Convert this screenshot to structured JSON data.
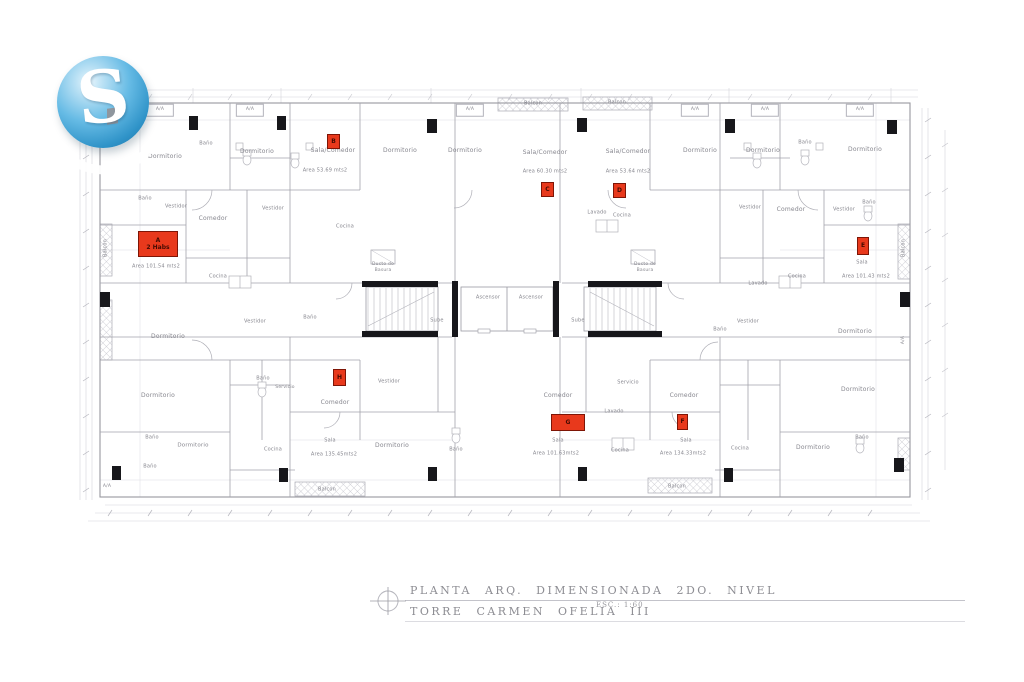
{
  "colors": {
    "unit_red": "#e8391c",
    "unit_red_border": "#7e1506",
    "line_gray": "#a3a3ab",
    "label_gray": "#86868e",
    "column_black": "#17171b",
    "logo_blue": "#4aa8d8"
  },
  "logo": {
    "letter": "S"
  },
  "title_block": {
    "line1": "PLANTA  ARQ.  DIMENSIONADA  2DO.  NIVEL",
    "line2": "TORRE  CARMEN  OFELIA  III",
    "scale": "ESC.: 1:60"
  },
  "plan": {
    "units": [
      {
        "id": "A",
        "label": "A",
        "sublabel": "2 Habs",
        "box": {
          "x": 138,
          "y": 231,
          "w": 38,
          "h": 24
        },
        "area": "Area 101.54 mts2",
        "area_pos": {
          "x": 156,
          "y": 267
        }
      },
      {
        "id": "B",
        "label": "B",
        "box": {
          "x": 327,
          "y": 134,
          "w": 11,
          "h": 13
        },
        "area": "Area 53.69 mts2",
        "area_pos": {
          "x": 325,
          "y": 171
        }
      },
      {
        "id": "C",
        "label": "C",
        "box": {
          "x": 541,
          "y": 182,
          "w": 11,
          "h": 13
        },
        "area": "Area 60.30 mts2",
        "area_pos": {
          "x": 545,
          "y": 172
        }
      },
      {
        "id": "D",
        "label": "D",
        "box": {
          "x": 613,
          "y": 183,
          "w": 11,
          "h": 13
        },
        "area": "Area 53.64 mts2",
        "area_pos": {
          "x": 628,
          "y": 172
        }
      },
      {
        "id": "E",
        "label": "E",
        "box": {
          "x": 857,
          "y": 237,
          "w": 10,
          "h": 16
        },
        "area": "Area 101.43 mts2",
        "area_pos": {
          "x": 866,
          "y": 277
        }
      },
      {
        "id": "F",
        "label": "F",
        "box": {
          "x": 677,
          "y": 414,
          "w": 9,
          "h": 14
        },
        "area": "Area 134.33mts2",
        "area_pos": {
          "x": 683,
          "y": 454
        }
      },
      {
        "id": "G",
        "label": "G",
        "box": {
          "x": 551,
          "y": 414,
          "w": 32,
          "h": 15
        },
        "area": "Area 101.63mts2",
        "area_pos": {
          "x": 556,
          "y": 454
        }
      },
      {
        "id": "H",
        "label": "H",
        "box": {
          "x": 333,
          "y": 369,
          "w": 11,
          "h": 15
        },
        "area": "Area 135.45mts2",
        "area_pos": {
          "x": 334,
          "y": 455
        }
      }
    ],
    "room_labels": [
      {
        "t": "Dormitorio",
        "x": 165,
        "y": 157
      },
      {
        "t": "Baño",
        "x": 206,
        "y": 144,
        "s": 5
      },
      {
        "t": "Dormitorio",
        "x": 257,
        "y": 152
      },
      {
        "t": "Sala/Comedor",
        "x": 333,
        "y": 151
      },
      {
        "t": "Dormitorio",
        "x": 400,
        "y": 151
      },
      {
        "t": "Dormitorio",
        "x": 465,
        "y": 151
      },
      {
        "t": "Sala/Comedor",
        "x": 545,
        "y": 153
      },
      {
        "t": "Sala/Comedor",
        "x": 628,
        "y": 152
      },
      {
        "t": "Dormitorio",
        "x": 700,
        "y": 151
      },
      {
        "t": "Dormitorio",
        "x": 763,
        "y": 151
      },
      {
        "t": "Baño",
        "x": 805,
        "y": 143,
        "s": 5
      },
      {
        "t": "Dormitorio",
        "x": 865,
        "y": 150
      },
      {
        "t": "Balcon",
        "x": 533,
        "y": 104,
        "s": 5
      },
      {
        "t": "Balcon",
        "x": 617,
        "y": 103,
        "s": 5
      },
      {
        "t": "A/A",
        "x": 160,
        "y": 110,
        "s": 4.5,
        "box": true
      },
      {
        "t": "A/A",
        "x": 250,
        "y": 110,
        "s": 4.5,
        "box": true
      },
      {
        "t": "A/A",
        "x": 470,
        "y": 110,
        "s": 4.5,
        "box": true
      },
      {
        "t": "A/A",
        "x": 695,
        "y": 110,
        "s": 4.5,
        "box": true
      },
      {
        "t": "A/A",
        "x": 765,
        "y": 110,
        "s": 4.5,
        "box": true
      },
      {
        "t": "A/A",
        "x": 860,
        "y": 110,
        "s": 4.5,
        "box": true
      },
      {
        "t": "Baño",
        "x": 145,
        "y": 199,
        "s": 5
      },
      {
        "t": "Vestidor",
        "x": 176,
        "y": 207,
        "s": 5
      },
      {
        "t": "Comedor",
        "x": 213,
        "y": 219
      },
      {
        "t": "Vestidor",
        "x": 273,
        "y": 209,
        "s": 5
      },
      {
        "t": "Cocina",
        "x": 218,
        "y": 277,
        "s": 5
      },
      {
        "t": "Cocina",
        "x": 345,
        "y": 227,
        "s": 5
      },
      {
        "t": "Lavado",
        "x": 597,
        "y": 213,
        "s": 5
      },
      {
        "t": "Cocina",
        "x": 622,
        "y": 216,
        "s": 5
      },
      {
        "t": "Vestidor",
        "x": 750,
        "y": 208,
        "s": 5
      },
      {
        "t": "Comedor",
        "x": 791,
        "y": 210
      },
      {
        "t": "Vestidor",
        "x": 844,
        "y": 210,
        "s": 5
      },
      {
        "t": "Baño",
        "x": 869,
        "y": 203,
        "s": 5
      },
      {
        "t": "Lavado",
        "x": 758,
        "y": 284,
        "s": 5
      },
      {
        "t": "Cocina",
        "x": 797,
        "y": 277,
        "s": 5
      },
      {
        "t": "Balcon",
        "x": 106,
        "y": 248,
        "s": 5,
        "r": -90
      },
      {
        "t": "Balcon",
        "x": 904,
        "y": 248,
        "s": 5,
        "r": -90
      },
      {
        "t": "Sala",
        "x": 862,
        "y": 263,
        "s": 5
      },
      {
        "t": "Ducto de",
        "x": 383,
        "y": 265,
        "s": 4.5
      },
      {
        "t": "Basura",
        "x": 383,
        "y": 271,
        "s": 4.5
      },
      {
        "t": "Ducto de",
        "x": 645,
        "y": 265,
        "s": 4.5
      },
      {
        "t": "Basura",
        "x": 645,
        "y": 271,
        "s": 4.5
      },
      {
        "t": "Ascensor",
        "x": 488,
        "y": 298,
        "s": 5
      },
      {
        "t": "Ascensor",
        "x": 531,
        "y": 298,
        "s": 5
      },
      {
        "t": "Sube",
        "x": 437,
        "y": 321,
        "s": 5
      },
      {
        "t": "Sube",
        "x": 578,
        "y": 321,
        "s": 5
      },
      {
        "t": "Dormitorio",
        "x": 168,
        "y": 337
      },
      {
        "t": "Vestidor",
        "x": 255,
        "y": 322,
        "s": 5
      },
      {
        "t": "Baño",
        "x": 310,
        "y": 318,
        "s": 5
      },
      {
        "t": "Dormitorio",
        "x": 158,
        "y": 396
      },
      {
        "t": "Baño",
        "x": 263,
        "y": 379,
        "s": 5
      },
      {
        "t": "Servicio",
        "x": 285,
        "y": 388,
        "s": 4.5
      },
      {
        "t": "Baño",
        "x": 152,
        "y": 438,
        "s": 5
      },
      {
        "t": "Dormitorio",
        "x": 193,
        "y": 446,
        "s": 5.5
      },
      {
        "t": "Baño",
        "x": 150,
        "y": 467,
        "s": 5
      },
      {
        "t": "Cocina",
        "x": 273,
        "y": 450,
        "s": 5
      },
      {
        "t": "Comedor",
        "x": 335,
        "y": 403
      },
      {
        "t": "Vestidor",
        "x": 389,
        "y": 382,
        "s": 5
      },
      {
        "t": "Sala",
        "x": 330,
        "y": 441,
        "s": 5
      },
      {
        "t": "Dormitorio",
        "x": 392,
        "y": 446
      },
      {
        "t": "Baño",
        "x": 456,
        "y": 450,
        "s": 5
      },
      {
        "t": "Balcon",
        "x": 327,
        "y": 490,
        "s": 5
      },
      {
        "t": "Servicio",
        "x": 628,
        "y": 383,
        "s": 5
      },
      {
        "t": "Lavado",
        "x": 614,
        "y": 412,
        "s": 5
      },
      {
        "t": "Comedor",
        "x": 558,
        "y": 396
      },
      {
        "t": "Sala",
        "x": 558,
        "y": 441,
        "s": 5
      },
      {
        "t": "Cocina",
        "x": 620,
        "y": 451,
        "s": 5
      },
      {
        "t": "Comedor",
        "x": 684,
        "y": 396
      },
      {
        "t": "Sala",
        "x": 686,
        "y": 441,
        "s": 5
      },
      {
        "t": "Cocina",
        "x": 740,
        "y": 449,
        "s": 5
      },
      {
        "t": "Dormitorio",
        "x": 813,
        "y": 448
      },
      {
        "t": "Balcon",
        "x": 677,
        "y": 487,
        "s": 5
      },
      {
        "t": "Dormitorio",
        "x": 855,
        "y": 332
      },
      {
        "t": "Dormitorio",
        "x": 858,
        "y": 390
      },
      {
        "t": "Vestidor",
        "x": 748,
        "y": 322,
        "s": 5
      },
      {
        "t": "Baño",
        "x": 720,
        "y": 330,
        "s": 5
      },
      {
        "t": "Baño",
        "x": 862,
        "y": 438,
        "s": 5
      },
      {
        "t": "A/A",
        "x": 107,
        "y": 487,
        "s": 4.5
      },
      {
        "t": "A/A",
        "x": 904,
        "y": 340,
        "s": 4.5,
        "r": -90
      }
    ]
  }
}
